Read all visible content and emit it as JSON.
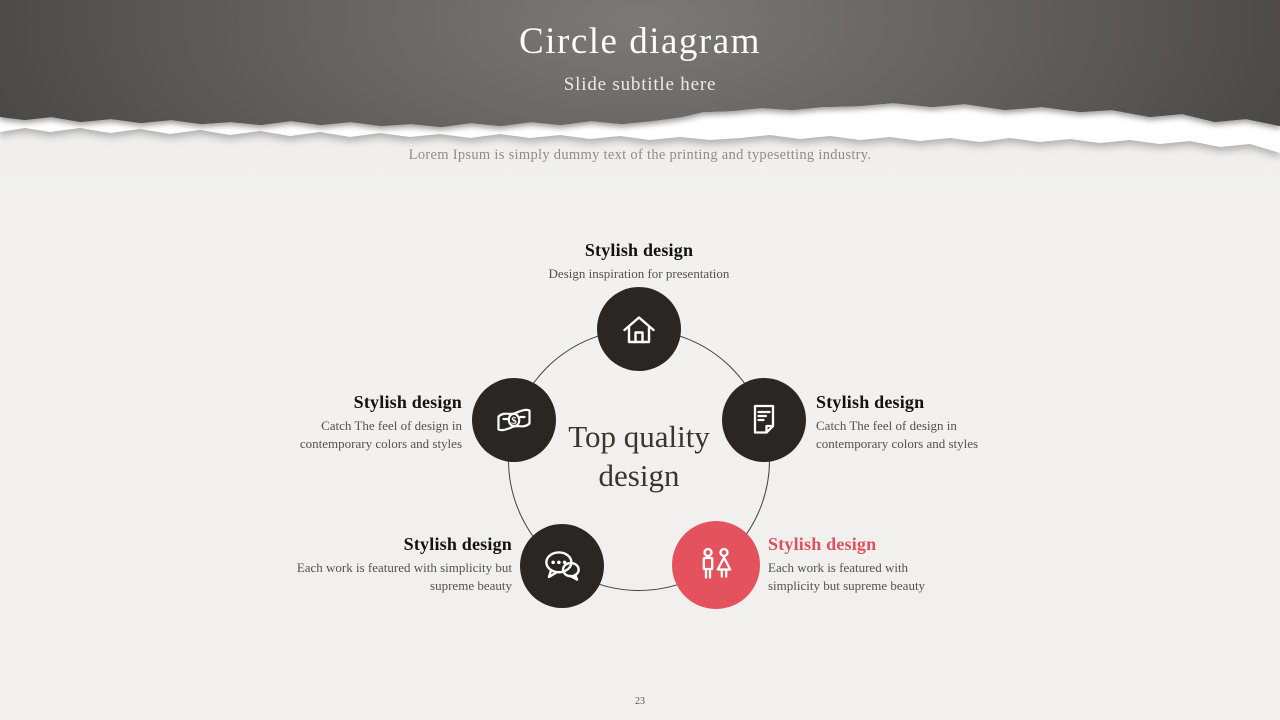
{
  "header": {
    "title": "Circle diagram",
    "subtitle": "Slide subtitle here"
  },
  "intro": "Lorem Ipsum is simply dummy text of the printing and typesetting industry.",
  "center_label": "Top quality design",
  "nodes": [
    {
      "position": "top",
      "icon": "home-icon",
      "title": "Stylish design",
      "description": "Design inspiration for presentation",
      "highlighted": false
    },
    {
      "position": "left",
      "icon": "money-icon",
      "title": "Stylish design",
      "description": "Catch The feel of design in contemporary colors and styles",
      "highlighted": false
    },
    {
      "position": "right",
      "icon": "document-icon",
      "title": "Stylish design",
      "description": "Catch The feel of design in contemporary colors and styles",
      "highlighted": false
    },
    {
      "position": "bottom-left",
      "icon": "chat-icon",
      "title": "Stylish design",
      "description": "Each work is featured with simplicity but supreme beauty",
      "highlighted": false
    },
    {
      "position": "bottom-right",
      "icon": "people-icon",
      "title": "Stylish design",
      "description": "Each work is featured with simplicity but supreme beauty",
      "highlighted": true
    }
  ],
  "icons": {
    "money_symbol": "$"
  },
  "page_number": "23",
  "colors": {
    "accent": "#e4525e",
    "accent_text": "#e0515e",
    "node_dark": "#2a2623",
    "header_dark": "#4a4745",
    "background": "#f1f0ee",
    "title_text": "#fcfcfb",
    "body_text": "#55514d"
  }
}
